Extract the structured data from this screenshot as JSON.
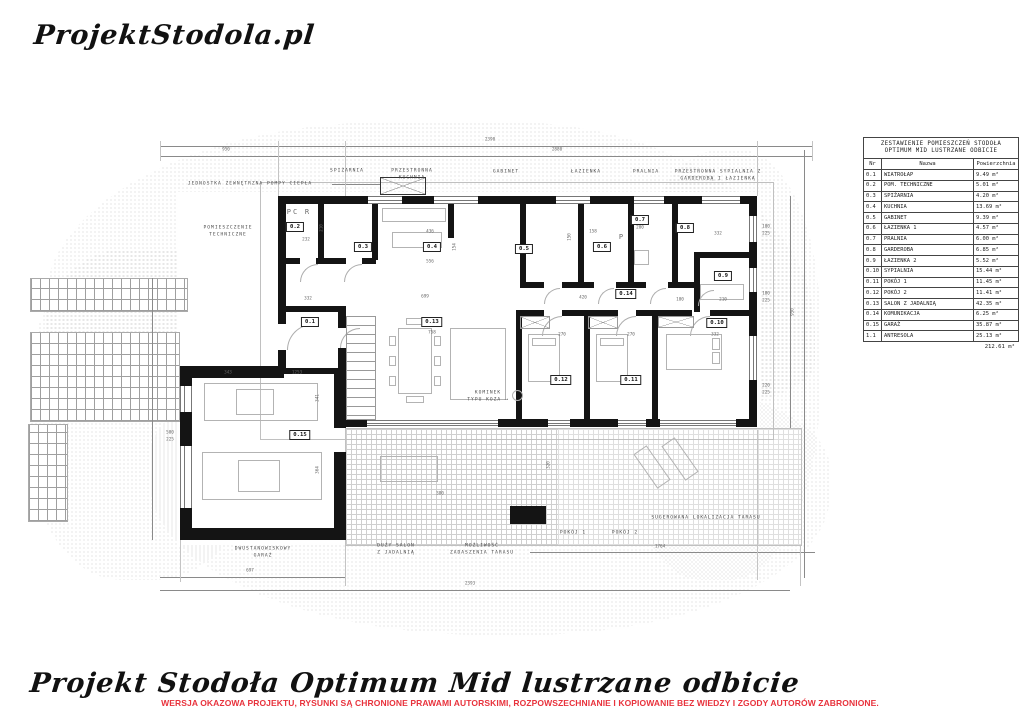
{
  "logo": "ProjektStodola.pl",
  "footer": {
    "title": "Projekt Stodoła Optimum Mid lustrzane odbicie",
    "disclaimer": "WERSJA OKAZOWA PROJEKTU, RYSUNKI  SĄ CHRONIONE PRAWAMI AUTORSKIMI, ROZPOWSZECHNIANIE I KOPIOWANIE BEZ WIEDZY I ZGODY AUTORÓW ZABRONIONE.",
    "disclaimer_color": "#e8323c"
  },
  "legend_table": {
    "title_line1": "ZESTAWIENIE POMIESZCZEŃ STODOŁA",
    "title_line2": "OPTIMUM MID LUSTRZANE ODBICIE",
    "columns": [
      "Nr",
      "Nazwa",
      "Powierzchnia"
    ],
    "rows": [
      [
        "0.1",
        "WIATROŁAP",
        "9.49 m²"
      ],
      [
        "0.2",
        "POM. TECHNICZNE",
        "5.01 m²"
      ],
      [
        "0.3",
        "SPIŻARNIA",
        "4.20 m²"
      ],
      [
        "0.4",
        "KUCHNIA",
        "13.69 m²"
      ],
      [
        "0.5",
        "GABINET",
        "9.39 m²"
      ],
      [
        "0.6",
        "ŁAZIENKA 1",
        "4.57 m²"
      ],
      [
        "0.7",
        "PRALNIA",
        "6.00 m²"
      ],
      [
        "0.8",
        "GARDEROBA",
        "6.85 m²"
      ],
      [
        "0.9",
        "ŁAZIENKA 2",
        "5.52 m²"
      ],
      [
        "0.10",
        "SYPIALNIA",
        "15.44 m²"
      ],
      [
        "0.11",
        "POKÓJ 1",
        "11.45 m²"
      ],
      [
        "0.12",
        "POKÓJ 2",
        "11.41 m²"
      ],
      [
        "0.13",
        "SALON Z JADALNIĄ",
        "42.35 m²"
      ],
      [
        "0.14",
        "KOMUNIKACJA",
        "6.25 m²"
      ],
      [
        "0.15",
        "GARAŻ",
        "35.87 m²"
      ],
      [
        "1.1",
        "ANTRESOLA",
        "25.13 m²"
      ]
    ],
    "total": "212.61 m²"
  },
  "plan": {
    "room_badges": [
      {
        "id": "0.1",
        "x": 310,
        "y": 322
      },
      {
        "id": "0.2",
        "x": 295,
        "y": 227
      },
      {
        "id": "0.3",
        "x": 363,
        "y": 247
      },
      {
        "id": "0.4",
        "x": 432,
        "y": 247
      },
      {
        "id": "0.5",
        "x": 524,
        "y": 249
      },
      {
        "id": "0.6",
        "x": 602,
        "y": 247
      },
      {
        "id": "0.7",
        "x": 640,
        "y": 220
      },
      {
        "id": "0.8",
        "x": 685,
        "y": 228
      },
      {
        "id": "0.9",
        "x": 723,
        "y": 276
      },
      {
        "id": "0.10",
        "x": 717,
        "y": 323
      },
      {
        "id": "0.11",
        "x": 631,
        "y": 380
      },
      {
        "id": "0.12",
        "x": 561,
        "y": 380
      },
      {
        "id": "0.13",
        "x": 432,
        "y": 322
      },
      {
        "id": "0.14",
        "x": 626,
        "y": 294
      },
      {
        "id": "0.15",
        "x": 300,
        "y": 435
      }
    ],
    "annotations": [
      {
        "t": "JEDNOSTKA ZEWNĘTRZNA POMPY CIEPŁA",
        "x": 250,
        "y": 184
      },
      {
        "t": "POMIESZCZENIE\nTECHNICZNE",
        "x": 228,
        "y": 232
      },
      {
        "t": "SPIŻARNIA",
        "x": 347,
        "y": 171
      },
      {
        "t": "PRZESTRONNA\nKUCHNIA",
        "x": 412,
        "y": 175
      },
      {
        "t": "GABINET",
        "x": 506,
        "y": 172
      },
      {
        "t": "ŁAZIENKA",
        "x": 586,
        "y": 172
      },
      {
        "t": "PRALNIA",
        "x": 646,
        "y": 172
      },
      {
        "t": "PRZESTRONNA SYPIALNIA Z\nGARDEROBĄ I ŁAZIENKĄ",
        "x": 718,
        "y": 176
      },
      {
        "t": "KOMINEK\nTYPU KOZA  ⟶",
        "x": 488,
        "y": 397
      },
      {
        "t": "DWUSTANOWISKOWY\nGARAŻ",
        "x": 263,
        "y": 553
      },
      {
        "t": "DUŻY SALON\nZ JADALNIĄ",
        "x": 396,
        "y": 550
      },
      {
        "t": "MOŻLIWOŚĆ\nZADASZENIA TARASU",
        "x": 482,
        "y": 550
      },
      {
        "t": "POKÓJ 1",
        "x": 573,
        "y": 533
      },
      {
        "t": "POKÓJ 2",
        "x": 625,
        "y": 533
      },
      {
        "t": "SUGEROWANA LOKALIZACJA TARASU",
        "x": 706,
        "y": 518
      }
    ],
    "inline_labels": [
      {
        "t": "PC",
        "x": 293,
        "y": 212
      },
      {
        "t": "R",
        "x": 308,
        "y": 212
      },
      {
        "t": "P",
        "x": 622,
        "y": 237
      }
    ],
    "dimensions": [
      {
        "t": "2390",
        "x": 490,
        "y": 140
      },
      {
        "t": "950",
        "x": 226,
        "y": 150
      },
      {
        "t": "2880",
        "x": 557,
        "y": 150
      },
      {
        "t": "232",
        "x": 306,
        "y": 240
      },
      {
        "t": "210",
        "x": 322,
        "y": 228,
        "r": 1
      },
      {
        "t": "436",
        "x": 430,
        "y": 232
      },
      {
        "t": "556",
        "x": 430,
        "y": 262
      },
      {
        "t": "154",
        "x": 455,
        "y": 247,
        "r": 1
      },
      {
        "t": "150",
        "x": 570,
        "y": 237,
        "r": 1
      },
      {
        "t": "158",
        "x": 593,
        "y": 232
      },
      {
        "t": "200",
        "x": 640,
        "y": 228
      },
      {
        "t": "332",
        "x": 718,
        "y": 234
      },
      {
        "t": "332",
        "x": 308,
        "y": 299
      },
      {
        "t": "699",
        "x": 425,
        "y": 297
      },
      {
        "t": "758",
        "x": 432,
        "y": 333
      },
      {
        "t": "420",
        "x": 583,
        "y": 298
      },
      {
        "t": "100",
        "x": 680,
        "y": 300
      },
      {
        "t": "210",
        "x": 723,
        "y": 300
      },
      {
        "t": "270",
        "x": 562,
        "y": 335
      },
      {
        "t": "270",
        "x": 631,
        "y": 335
      },
      {
        "t": "332",
        "x": 715,
        "y": 335
      },
      {
        "t": "343",
        "x": 228,
        "y": 373
      },
      {
        "t": "1253",
        "x": 297,
        "y": 373
      },
      {
        "t": "341",
        "x": 318,
        "y": 398,
        "r": 1
      },
      {
        "t": "364",
        "x": 318,
        "y": 470,
        "r": 1
      },
      {
        "t": "500",
        "x": 170,
        "y": 433
      },
      {
        "t": "225",
        "x": 170,
        "y": 440
      },
      {
        "t": "380",
        "x": 440,
        "y": 494
      },
      {
        "t": "320",
        "x": 549,
        "y": 465,
        "r": 1
      },
      {
        "t": "950",
        "x": 793,
        "y": 312,
        "r": 1
      },
      {
        "t": "100",
        "x": 766,
        "y": 227
      },
      {
        "t": "225",
        "x": 766,
        "y": 234
      },
      {
        "t": "180",
        "x": 766,
        "y": 294
      },
      {
        "t": "225",
        "x": 766,
        "y": 301
      },
      {
        "t": "220",
        "x": 766,
        "y": 386
      },
      {
        "t": "225",
        "x": 766,
        "y": 393
      },
      {
        "t": "1764",
        "x": 660,
        "y": 547
      },
      {
        "t": "697",
        "x": 250,
        "y": 571
      },
      {
        "t": "2393",
        "x": 470,
        "y": 584
      }
    ]
  }
}
